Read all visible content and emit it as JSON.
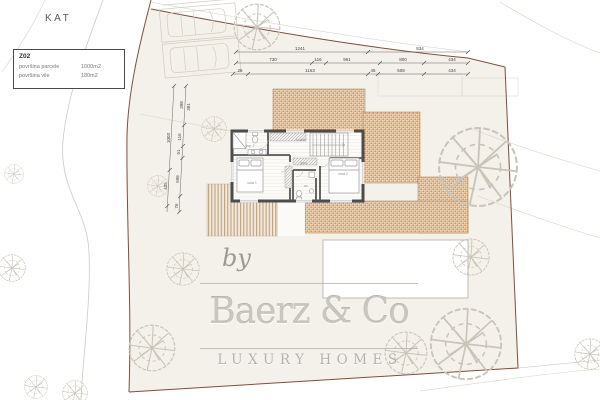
{
  "title": "KAT",
  "info_box": {
    "code": "Z02",
    "rows": [
      {
        "label": "površina parcele",
        "value": "1000m2"
      },
      {
        "label": "površina vile",
        "value": "180m2"
      }
    ]
  },
  "watermark": {
    "by": "by",
    "brand": "Baerz & Co",
    "tagline": "LUXURY HOMES"
  },
  "colors": {
    "parcel_fill": "#f3f1ea",
    "terrace_hatch_dark": "#c9894e",
    "terrace_hatch_light": "#e0b080",
    "deck_stripe": "#c2a17c",
    "boundary": "#7d4f3c",
    "house_wall": "#4c4c4c",
    "dimension_text": "#444444"
  },
  "dimensions": {
    "horizontal_rows": [
      {
        "y": 52,
        "x1": 236,
        "x2": 468,
        "ticks": [
          236,
          368,
          468
        ],
        "labels": [
          {
            "t": "1241",
            "x": 300
          },
          {
            "t": "834",
            "x": 420
          }
        ]
      },
      {
        "y": 63,
        "x1": 236,
        "x2": 468,
        "ticks": [
          236,
          312,
          326,
          380,
          424,
          468
        ],
        "labels": [
          {
            "t": "730",
            "x": 273
          },
          {
            "t": "116",
            "x": 318
          },
          {
            "t": "961",
            "x": 347
          },
          {
            "t": "800",
            "x": 403
          },
          {
            "t": "434",
            "x": 452
          }
        ]
      },
      {
        "y": 74,
        "x1": 233,
        "x2": 468,
        "ticks": [
          233,
          248,
          368,
          378,
          424,
          468
        ],
        "labels": [
          {
            "t": "26",
            "x": 240
          },
          {
            "t": "1163",
            "x": 310
          },
          {
            "t": "45",
            "x": 373
          },
          {
            "t": "508",
            "x": 401
          },
          {
            "t": "434",
            "x": 452
          }
        ]
      }
    ],
    "vertical_labels": [
      {
        "t": "1003",
        "x": 170,
        "y": 138
      },
      {
        "t": "435",
        "x": 167,
        "y": 186
      },
      {
        "t": "398",
        "x": 183,
        "y": 105
      },
      {
        "t": "381",
        "x": 190,
        "y": 107
      },
      {
        "t": "116",
        "x": 181,
        "y": 137
      },
      {
        "t": "51",
        "x": 180,
        "y": 152
      },
      {
        "t": "596",
        "x": 179,
        "y": 179
      },
      {
        "t": "76",
        "x": 178,
        "y": 206
      }
    ]
  },
  "room_labels": [
    {
      "t": "kup. 2",
      "x": 250,
      "y": 147
    },
    {
      "t": "soba 1",
      "x": 252,
      "y": 184
    },
    {
      "t": "hodnik",
      "x": 301,
      "y": 141
    },
    {
      "t": "gard.",
      "x": 304,
      "y": 164
    },
    {
      "t": "wc",
      "x": 306,
      "y": 187
    },
    {
      "t": "soba 2",
      "x": 343,
      "y": 175
    }
  ]
}
